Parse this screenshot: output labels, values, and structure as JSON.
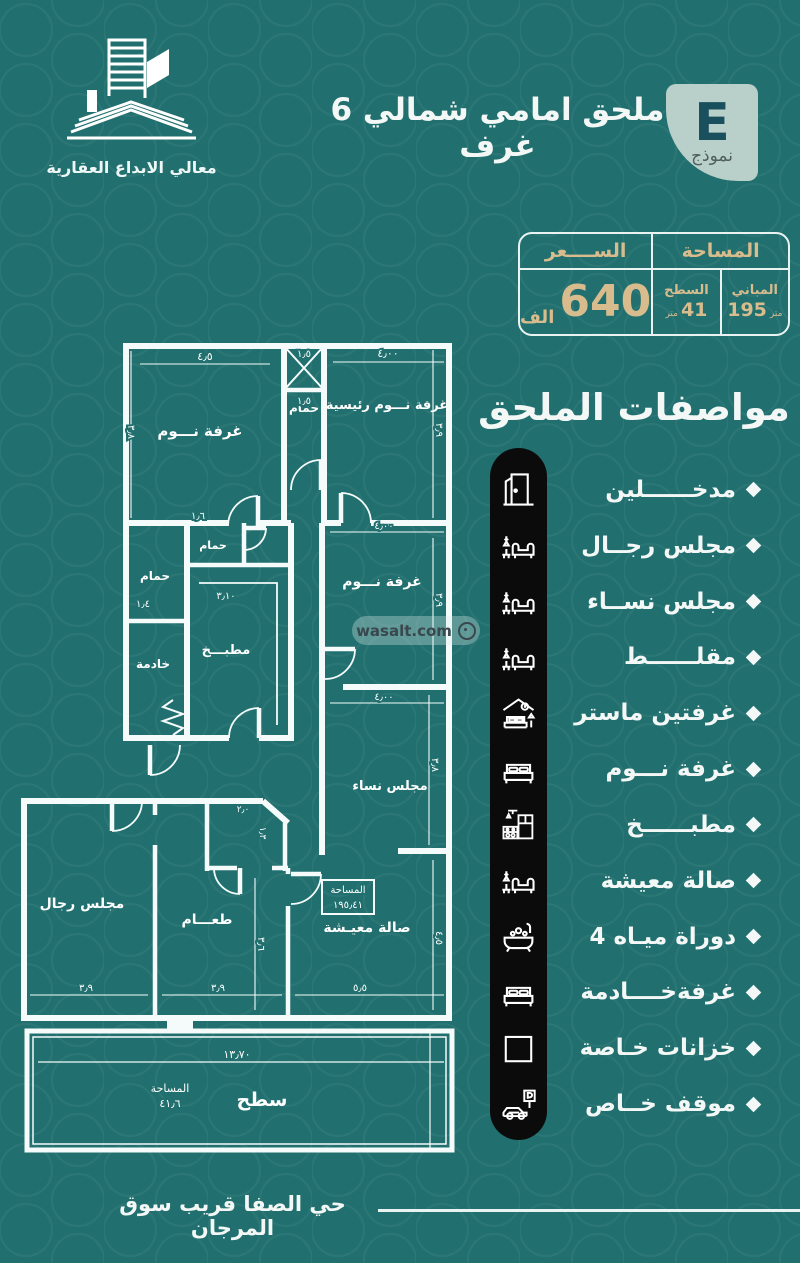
{
  "brand": {
    "name": "معالي الابداع العقارية"
  },
  "header": {
    "title": "ملحق امامي شمالي 6 غرف",
    "badge_letter": "E",
    "badge_label": "نموذج"
  },
  "pricing": {
    "price_header": "الســــعر",
    "price_value": "640",
    "price_unit": "الف",
    "area_header": "المساحة",
    "buildings_label": "المباني",
    "buildings_value": "195",
    "buildings_unit": "متر",
    "roof_label": "السطح",
    "roof_value": "41",
    "roof_unit": "متر"
  },
  "specs": {
    "heading": "مواصفات الملحق",
    "items": [
      {
        "label": "مدخــــــلين",
        "icon": "door-icon"
      },
      {
        "label": "مجلس رجــال",
        "icon": "sofa-icon"
      },
      {
        "label": "مجلس نســاء",
        "icon": "sofa-icon"
      },
      {
        "label": "مقلــــــط",
        "icon": "sofa-icon"
      },
      {
        "label": "غرفتين ماستر",
        "icon": "master-bed-icon"
      },
      {
        "label": "غرفة نـــوم",
        "icon": "bed-icon"
      },
      {
        "label": "مطبــــــخ",
        "icon": "kitchen-icon"
      },
      {
        "label": "صالة معيشة",
        "icon": "sofa-icon"
      },
      {
        "label": "4 دوراة ميـاه",
        "icon": "bathtub-icon"
      },
      {
        "label": "غرفةخــــادمة",
        "icon": "bed-icon"
      },
      {
        "label": "خزانات خـاصة",
        "icon": "square-icon"
      },
      {
        "label": "موقف خــاص",
        "icon": "car-parking-icon"
      }
    ]
  },
  "floor_plan": {
    "room_labels": [
      {
        "label": "غرفة نـــوم",
        "x": 200,
        "y": 436,
        "size": 15
      },
      {
        "label": "حمام",
        "x": 304,
        "y": 412,
        "size": 12
      },
      {
        "label": "غرفة نـــوم رئيسية",
        "x": 387,
        "y": 409,
        "size": 13
      },
      {
        "label": "حمام",
        "x": 155,
        "y": 580,
        "size": 12
      },
      {
        "label": "حمام",
        "x": 213,
        "y": 549,
        "size": 11
      },
      {
        "label": "خادمة",
        "x": 153,
        "y": 668,
        "size": 12
      },
      {
        "label": "مطبـــخ",
        "x": 226,
        "y": 654,
        "size": 13
      },
      {
        "label": "غرفة نـــوم",
        "x": 382,
        "y": 586,
        "size": 14
      },
      {
        "label": "مجلس نساء",
        "x": 390,
        "y": 790,
        "size": 13
      },
      {
        "label": "مجلس رجال",
        "x": 82,
        "y": 908,
        "size": 14
      },
      {
        "label": "طعـــام",
        "x": 207,
        "y": 924,
        "size": 14
      },
      {
        "label": "صالة معيـشة",
        "x": 367,
        "y": 932,
        "size": 14
      },
      {
        "label": "سطح",
        "x": 262,
        "y": 1106,
        "size": 19
      }
    ],
    "dimensions": [
      {
        "label": "٤٫٥",
        "x": 205,
        "y": 360,
        "size": 11
      },
      {
        "label": "١٫٥",
        "x": 304,
        "y": 357,
        "size": 10
      },
      {
        "label": "١٫٥",
        "x": 304,
        "y": 404,
        "size": 10
      },
      {
        "label": "٤٫٠٠",
        "x": 388,
        "y": 357,
        "size": 11
      },
      {
        "label": "٣٫٩",
        "x": 436,
        "y": 430,
        "size": 10,
        "rot": 90
      },
      {
        "label": "٣٫٨",
        "x": 128,
        "y": 432,
        "size": 10,
        "rot": 90
      },
      {
        "label": "١٫٦",
        "x": 198,
        "y": 519,
        "size": 10
      },
      {
        "label": "١٫٤",
        "x": 143,
        "y": 607,
        "size": 10
      },
      {
        "label": "٣٫١٠",
        "x": 226,
        "y": 599,
        "size": 10
      },
      {
        "label": "٤٫٠٠",
        "x": 384,
        "y": 529,
        "size": 10
      },
      {
        "label": "٣٫٩",
        "x": 436,
        "y": 600,
        "size": 10,
        "rot": 90
      },
      {
        "label": "٤٫٠٠",
        "x": 384,
        "y": 700,
        "size": 10
      },
      {
        "label": "٣٫٨",
        "x": 432,
        "y": 765,
        "size": 10,
        "rot": 90
      },
      {
        "label": "٢٫٠",
        "x": 243,
        "y": 812,
        "size": 9
      },
      {
        "label": "١٫٣",
        "x": 260,
        "y": 833,
        "size": 9,
        "rot": 90
      },
      {
        "label": "٣٫٩",
        "x": 86,
        "y": 991,
        "size": 10
      },
      {
        "label": "٣٫٩",
        "x": 218,
        "y": 991,
        "size": 10
      },
      {
        "label": "٥٫٥",
        "x": 360,
        "y": 991,
        "size": 10
      },
      {
        "label": "٣٫٦",
        "x": 258,
        "y": 944,
        "size": 10,
        "rot": 90
      },
      {
        "label": "٤٫٥",
        "x": 436,
        "y": 938,
        "size": 10,
        "rot": 90
      },
      {
        "label": "١٣٫٧٠",
        "x": 237,
        "y": 1058,
        "size": 11
      }
    ],
    "area_box": {
      "title": "المساحة",
      "value": "١٩٥٫٤١"
    },
    "roof_area": {
      "title": "المساحة",
      "value": "٤١٫٦"
    }
  },
  "watermark": {
    "text": "wasalt.com"
  },
  "footer": {
    "location": "حي الصفا قريب سوق المرجان"
  },
  "colors": {
    "background": "#21706f",
    "gold": "#d9bc8d",
    "bar_black": "#0b0b0b",
    "badge_bg": "#b9cfca",
    "badge_letter": "#1a4f5e",
    "white": "#f3f8f7"
  }
}
